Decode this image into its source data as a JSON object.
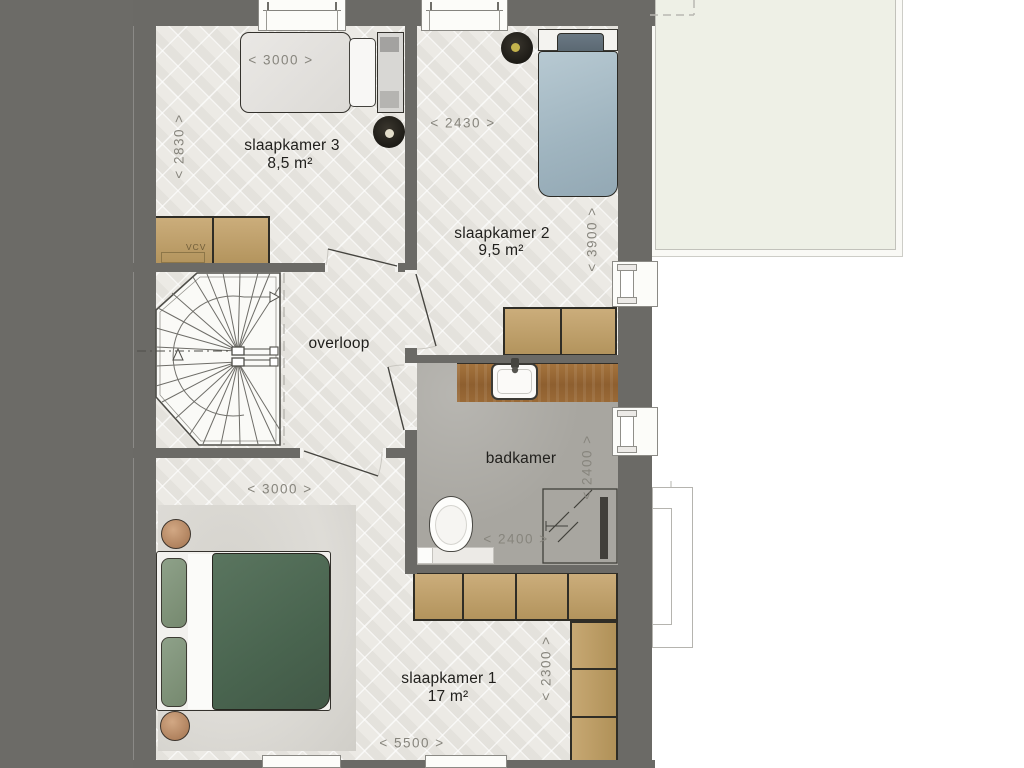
{
  "plan_title": "floor plan - first floor (verdieping)",
  "rooms": [
    {
      "name": "slaapkamer 3",
      "area": "8,5 m²"
    },
    {
      "name": "slaapkamer 2",
      "area": "9,5 m²"
    },
    {
      "name": "overloop",
      "area": ""
    },
    {
      "name": "badkamer",
      "area": ""
    },
    {
      "name": "slaapkamer 1",
      "area": "17 m²"
    }
  ],
  "dimensions": {
    "sk3_width": "< 3000 >",
    "sk3_depth": "< 2830 >",
    "sk2_width": "< 2430 >",
    "sk2_depth": "< 3900 >",
    "bad_depth": "< 2400 >",
    "bad_width": "< 2400 >",
    "sk1_width_top": "< 3000 >",
    "sk1_depth": "< 2300 >",
    "sk1_width_bottom": "< 5500 >"
  },
  "annotations": {
    "vcv": "VCV"
  },
  "palette": {
    "wall": "#6b6a66",
    "floor": "#eceae5",
    "bath_floor": "#a8a6a0",
    "cabinet_wood": "#c0a26e",
    "counter_wood": "#9a6a37",
    "bed_green": "#4d6853",
    "bed_blue": "#a9bfca",
    "pouf_tan": "#c09878",
    "accent_black": "#211e19",
    "roof_terrace": "#eef0e6",
    "background_right": "#ffffff"
  }
}
